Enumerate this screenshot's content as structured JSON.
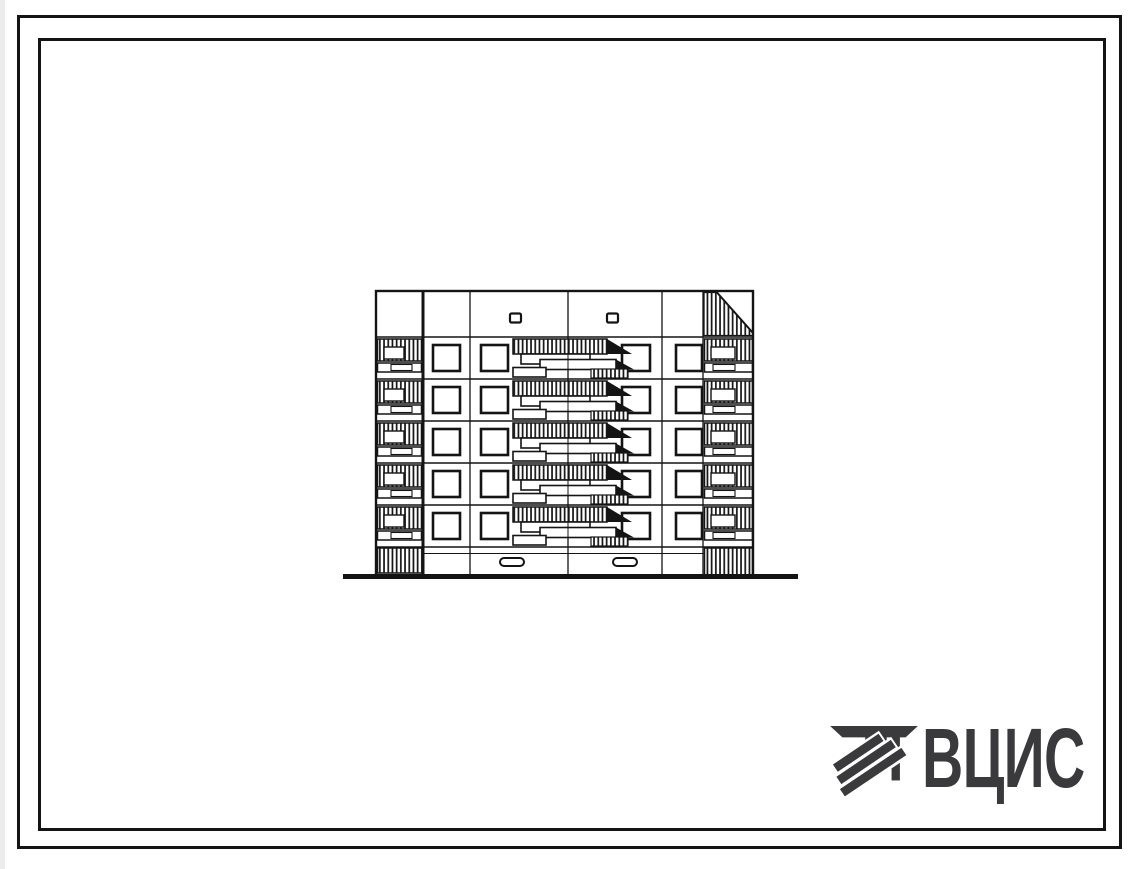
{
  "page": {
    "background_color": "#ffffff",
    "frame_color": "#141414",
    "ink_color": "#141414",
    "frames": 2
  },
  "drawing": {
    "kind": "panel apartment building end-section elevation, black ink line drawing",
    "storeys": 5,
    "windows_per_storey": 4,
    "features": {
      "left_edge": "stacked hatched balconies",
      "right_edge": "stacked hatched balconies with hatched parapet corner",
      "center": "staircase loggia with stepped hatched railings and slabs",
      "parapet_vents": 2,
      "basement_vents": 2,
      "ground_line": "thick horizontal line under the building"
    }
  },
  "logo": {
    "text": "ВЦИС",
    "color": "#3a3a3c",
    "icon": "diagonal-striped-monogram-icon"
  }
}
